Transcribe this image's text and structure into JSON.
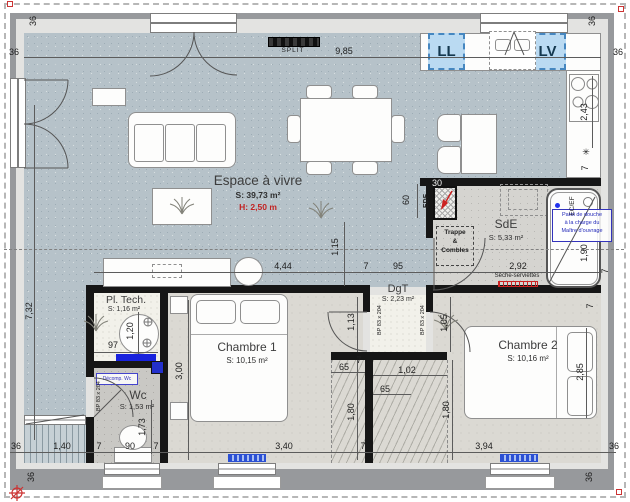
{
  "title": "Plan de maison - rez-de-chaussée",
  "rooms": {
    "living": {
      "name": "Espace à vivre",
      "area": "S: 39,73 m²",
      "height": "H: 2,50 m"
    },
    "chambre1": {
      "name": "Chambre 1",
      "area": "S: 10,15 m²"
    },
    "chambre2": {
      "name": "Chambre 2",
      "area": "S: 10,16 m²"
    },
    "sde": {
      "name": "SdE",
      "area": "S: 5,33 m²"
    },
    "dgt": {
      "name": "DgT",
      "area": "S: 2,23 m²"
    },
    "wc": {
      "name": "Wc",
      "area": "S: 1,53 m²"
    },
    "pltech": {
      "name": "Pl. Tech.",
      "area": "S: 1,16 m²"
    }
  },
  "labels": {
    "split": "SPLIT",
    "ll": "LL",
    "lv": "LV",
    "edf": "EDF",
    "ecef": "EC/EF",
    "trappe": "Trappe",
    "amp": "&",
    "combles": "Combles",
    "seche_serviettes": "Sèche-serviettes",
    "paroi_note": [
      "Paroi de douche",
      "à la charge du",
      "Maître d'ouvrage"
    ],
    "decomp_wc": "Décomp. Wc",
    "door_bp": "BP 83 x 204",
    "star": "✳"
  },
  "dims": {
    "overall_width": "9,85",
    "overall_depth": "7,32",
    "wall": "36",
    "seven": "7",
    "kitchen_depth": "2,43",
    "duct_h": "60",
    "duct_w": "30",
    "k_offset": "1,15",
    "living_w": "4,44",
    "dgt_opening": "95",
    "sde_w": "2,92",
    "pltech_w": "97",
    "pltech_d": "1,20",
    "wc_d": "1,73",
    "wc_door": "90",
    "deck_w": "1,40",
    "ch1_w": "3,40",
    "ch1_d": "3,00",
    "closet_d": "65",
    "closet_h": "1,80",
    "closet2_w": "1,02",
    "ch2_w": "3,94",
    "ch2_d": "2,85",
    "ch2_entry": "1,05",
    "dgt_d": "1,13",
    "shower_l": "1,90"
  },
  "colors": {
    "living_floor": "#b6c2c9",
    "bedroom_floor": "#dbd9d3",
    "appliance_blue": "#badaf2",
    "height_red": "#c22222",
    "radiator_blue": "#2b50d4"
  }
}
